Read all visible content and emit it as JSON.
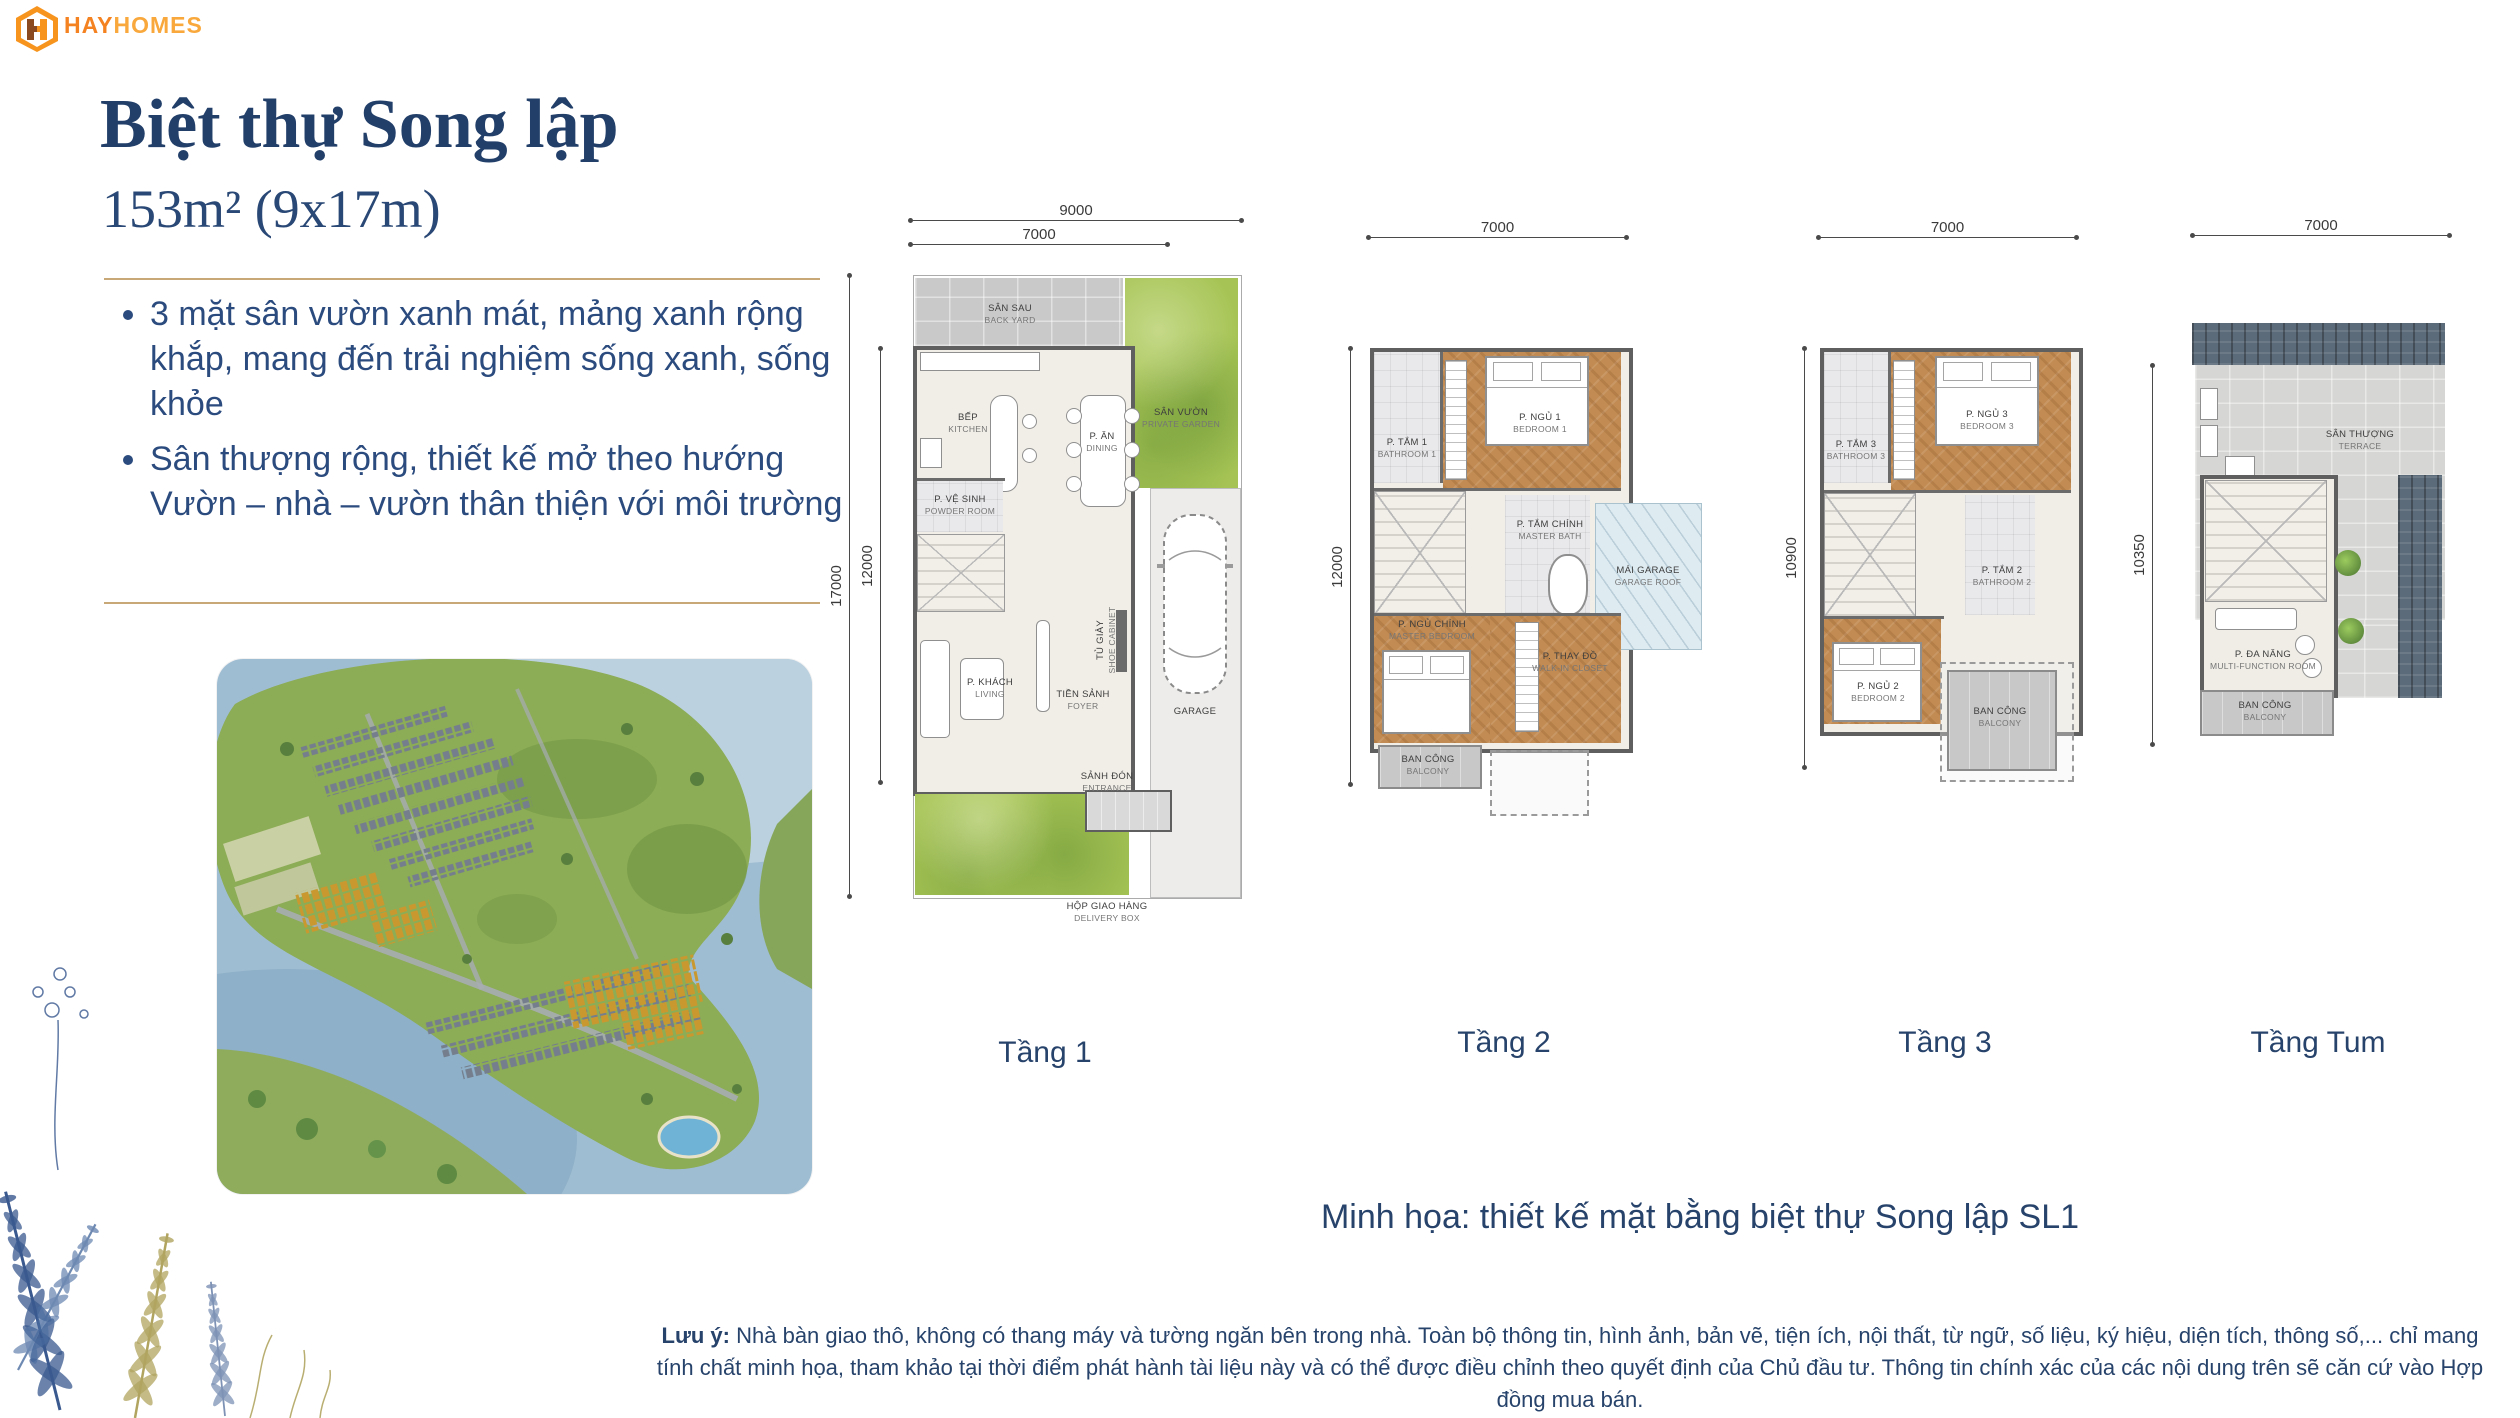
{
  "logo": {
    "brand_primary": "HAY",
    "brand_secondary": "HOMES"
  },
  "header": {
    "title": "Biệt thự Song lập",
    "area": "153m² (9x17m)"
  },
  "features": [
    {
      "text": "3 mặt sân vườn xanh mát, mảng xanh rộng khắp, mang đến trải nghiệm sống xanh, sống khỏe"
    },
    {
      "text": "Sân thượng rộng, thiết kế mở theo hướng Vườn – nhà – vườn thân thiện với môi trường"
    }
  ],
  "plans": {
    "p1": {
      "label": "Tầng 1",
      "dims": {
        "top_outer": "9000",
        "top_inner": "7000",
        "left_outer": "17000",
        "left_inner": "12000"
      },
      "rooms": {
        "backyard": {
          "vi": "SÂN SAU",
          "en": "BACK YARD"
        },
        "kitchen": {
          "vi": "BẾP",
          "en": "KITCHEN"
        },
        "dining": {
          "vi": "P. ĂN",
          "en": "DINING"
        },
        "garden": {
          "vi": "SÂN VƯỜN",
          "en": "PRIVATE GARDEN"
        },
        "powder": {
          "vi": "P. VỆ SINH",
          "en": "POWDER ROOM"
        },
        "living": {
          "vi": "P. KHÁCH",
          "en": "LIVING"
        },
        "foyer": {
          "vi": "TIỀN SẢNH",
          "en": "FOYER"
        },
        "shoe": {
          "vi": "TỦ GIÀY",
          "en": "SHOE CABINET"
        },
        "entrance": {
          "vi": "SẢNH ĐÓN",
          "en": "ENTRANCE"
        },
        "garage": {
          "vi": "GARAGE",
          "en": ""
        },
        "delivery": {
          "vi": "HỘP GIAO HÀNG",
          "en": "DELIVERY BOX"
        }
      }
    },
    "p2": {
      "label": "Tầng 2",
      "dims": {
        "top": "7000",
        "left": "12000"
      },
      "rooms": {
        "bathroom1": {
          "vi": "P. TẮM 1",
          "en": "BATHROOM 1"
        },
        "bedroom1": {
          "vi": "P. NGỦ 1",
          "en": "BEDROOM 1"
        },
        "master_bath": {
          "vi": "P. TẮM CHÍNH",
          "en": "MASTER BATH"
        },
        "garage_roof": {
          "vi": "MÁI GARAGE",
          "en": "GARAGE ROOF"
        },
        "master_bedroom": {
          "vi": "P. NGỦ CHÍNH",
          "en": "MASTER BEDROOM"
        },
        "closet": {
          "vi": "P. THAY ĐỒ",
          "en": "WALK-IN CLOSET"
        },
        "balcony": {
          "vi": "BAN CÔNG",
          "en": "BALCONY"
        }
      }
    },
    "p3": {
      "label": "Tầng 3",
      "dims": {
        "top": "7000",
        "left": "10900"
      },
      "rooms": {
        "bathroom3": {
          "vi": "P. TẮM 3",
          "en": "BATHROOM 3"
        },
        "bedroom3": {
          "vi": "P. NGỦ 3",
          "en": "BEDROOM 3"
        },
        "bathroom2": {
          "vi": "P. TẮM 2",
          "en": "BATHROOM 2"
        },
        "bedroom2": {
          "vi": "P. NGỦ 2",
          "en": "BEDROOM 2"
        },
        "balcony": {
          "vi": "BAN CÔNG",
          "en": "BALCONY"
        }
      }
    },
    "p4": {
      "label": "Tầng Tum",
      "dims": {
        "top": "7000",
        "left": "10350"
      },
      "rooms": {
        "terrace": {
          "vi": "SÂN THƯỢNG",
          "en": "TERRACE"
        },
        "multi": {
          "vi": "P. ĐA NĂNG",
          "en": "MULTI-FUNCTION ROOM"
        },
        "balcony": {
          "vi": "BAN CÔNG",
          "en": "BALCONY"
        }
      }
    }
  },
  "caption": "Minh họa: thiết kế mặt bằng biệt thự Song lập SL1",
  "footer": {
    "label": "Lưu ý:",
    "text": "Nhà bàn giao thô, không có thang máy và tường ngăn bên trong nhà. Toàn bộ thông tin, hình ảnh, bản vẽ, tiện ích, nội thất, từ ngữ, số liệu, ký hiệu, diện tích, thông số,... chỉ mang tính chất minh họa, tham khảo tại thời điểm phát hành tài liệu này và có thể được điều chỉnh theo quyết định của Chủ đầu tư. Thông tin chính xác của các nội dung trên sẽ căn cứ vào Hợp đồng mua bán."
  },
  "colors": {
    "accent_navy": "#27436B",
    "accent_gold": "#C9A878",
    "brand_orange": "#F58220"
  }
}
